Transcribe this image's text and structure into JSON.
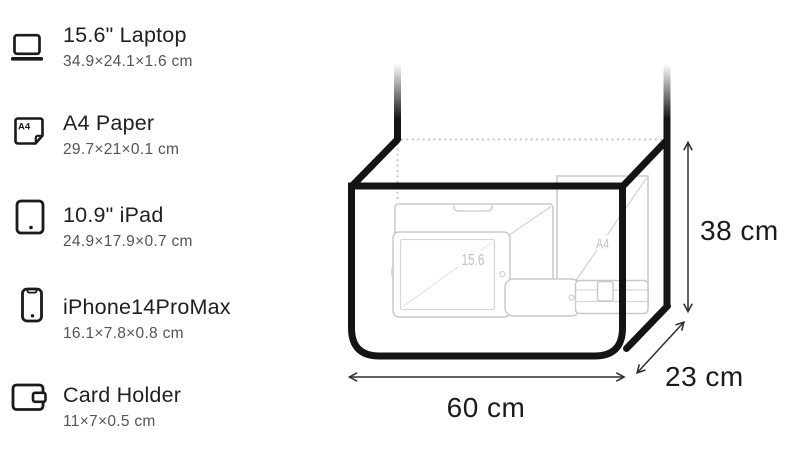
{
  "items": [
    {
      "title": "15.6\" Laptop",
      "dimensions": "34.9×24.1×1.6 cm"
    },
    {
      "title": "A4 Paper",
      "dimensions": "29.7×21×0.1 cm"
    },
    {
      "title": "10.9\" iPad",
      "dimensions": "24.9×17.9×0.7 cm"
    },
    {
      "title": "iPhone14ProMax",
      "dimensions": "16.1×7.8×0.8 cm"
    },
    {
      "title": "Card Holder",
      "dimensions": "11×7×0.5 cm"
    }
  ],
  "icons": {
    "a4_label": "A4"
  },
  "diagram": {
    "bag_width_label": "60 cm",
    "bag_height_label": "38 cm",
    "bag_depth_label": "23 cm",
    "laptop_diagonal_label": "15.6",
    "a4_sheet_label": "A4"
  },
  "colors": {
    "bag_outline": "#141414",
    "content_outline": "#c9c9c9",
    "content_label": "#c0c0c0",
    "dimension_line": "#2f2f2f",
    "dimension_text": "#1b1b1b",
    "title_text": "#202020",
    "subtitle_text": "#545454",
    "hidden_edge_dotted": "#c8c8c8"
  }
}
